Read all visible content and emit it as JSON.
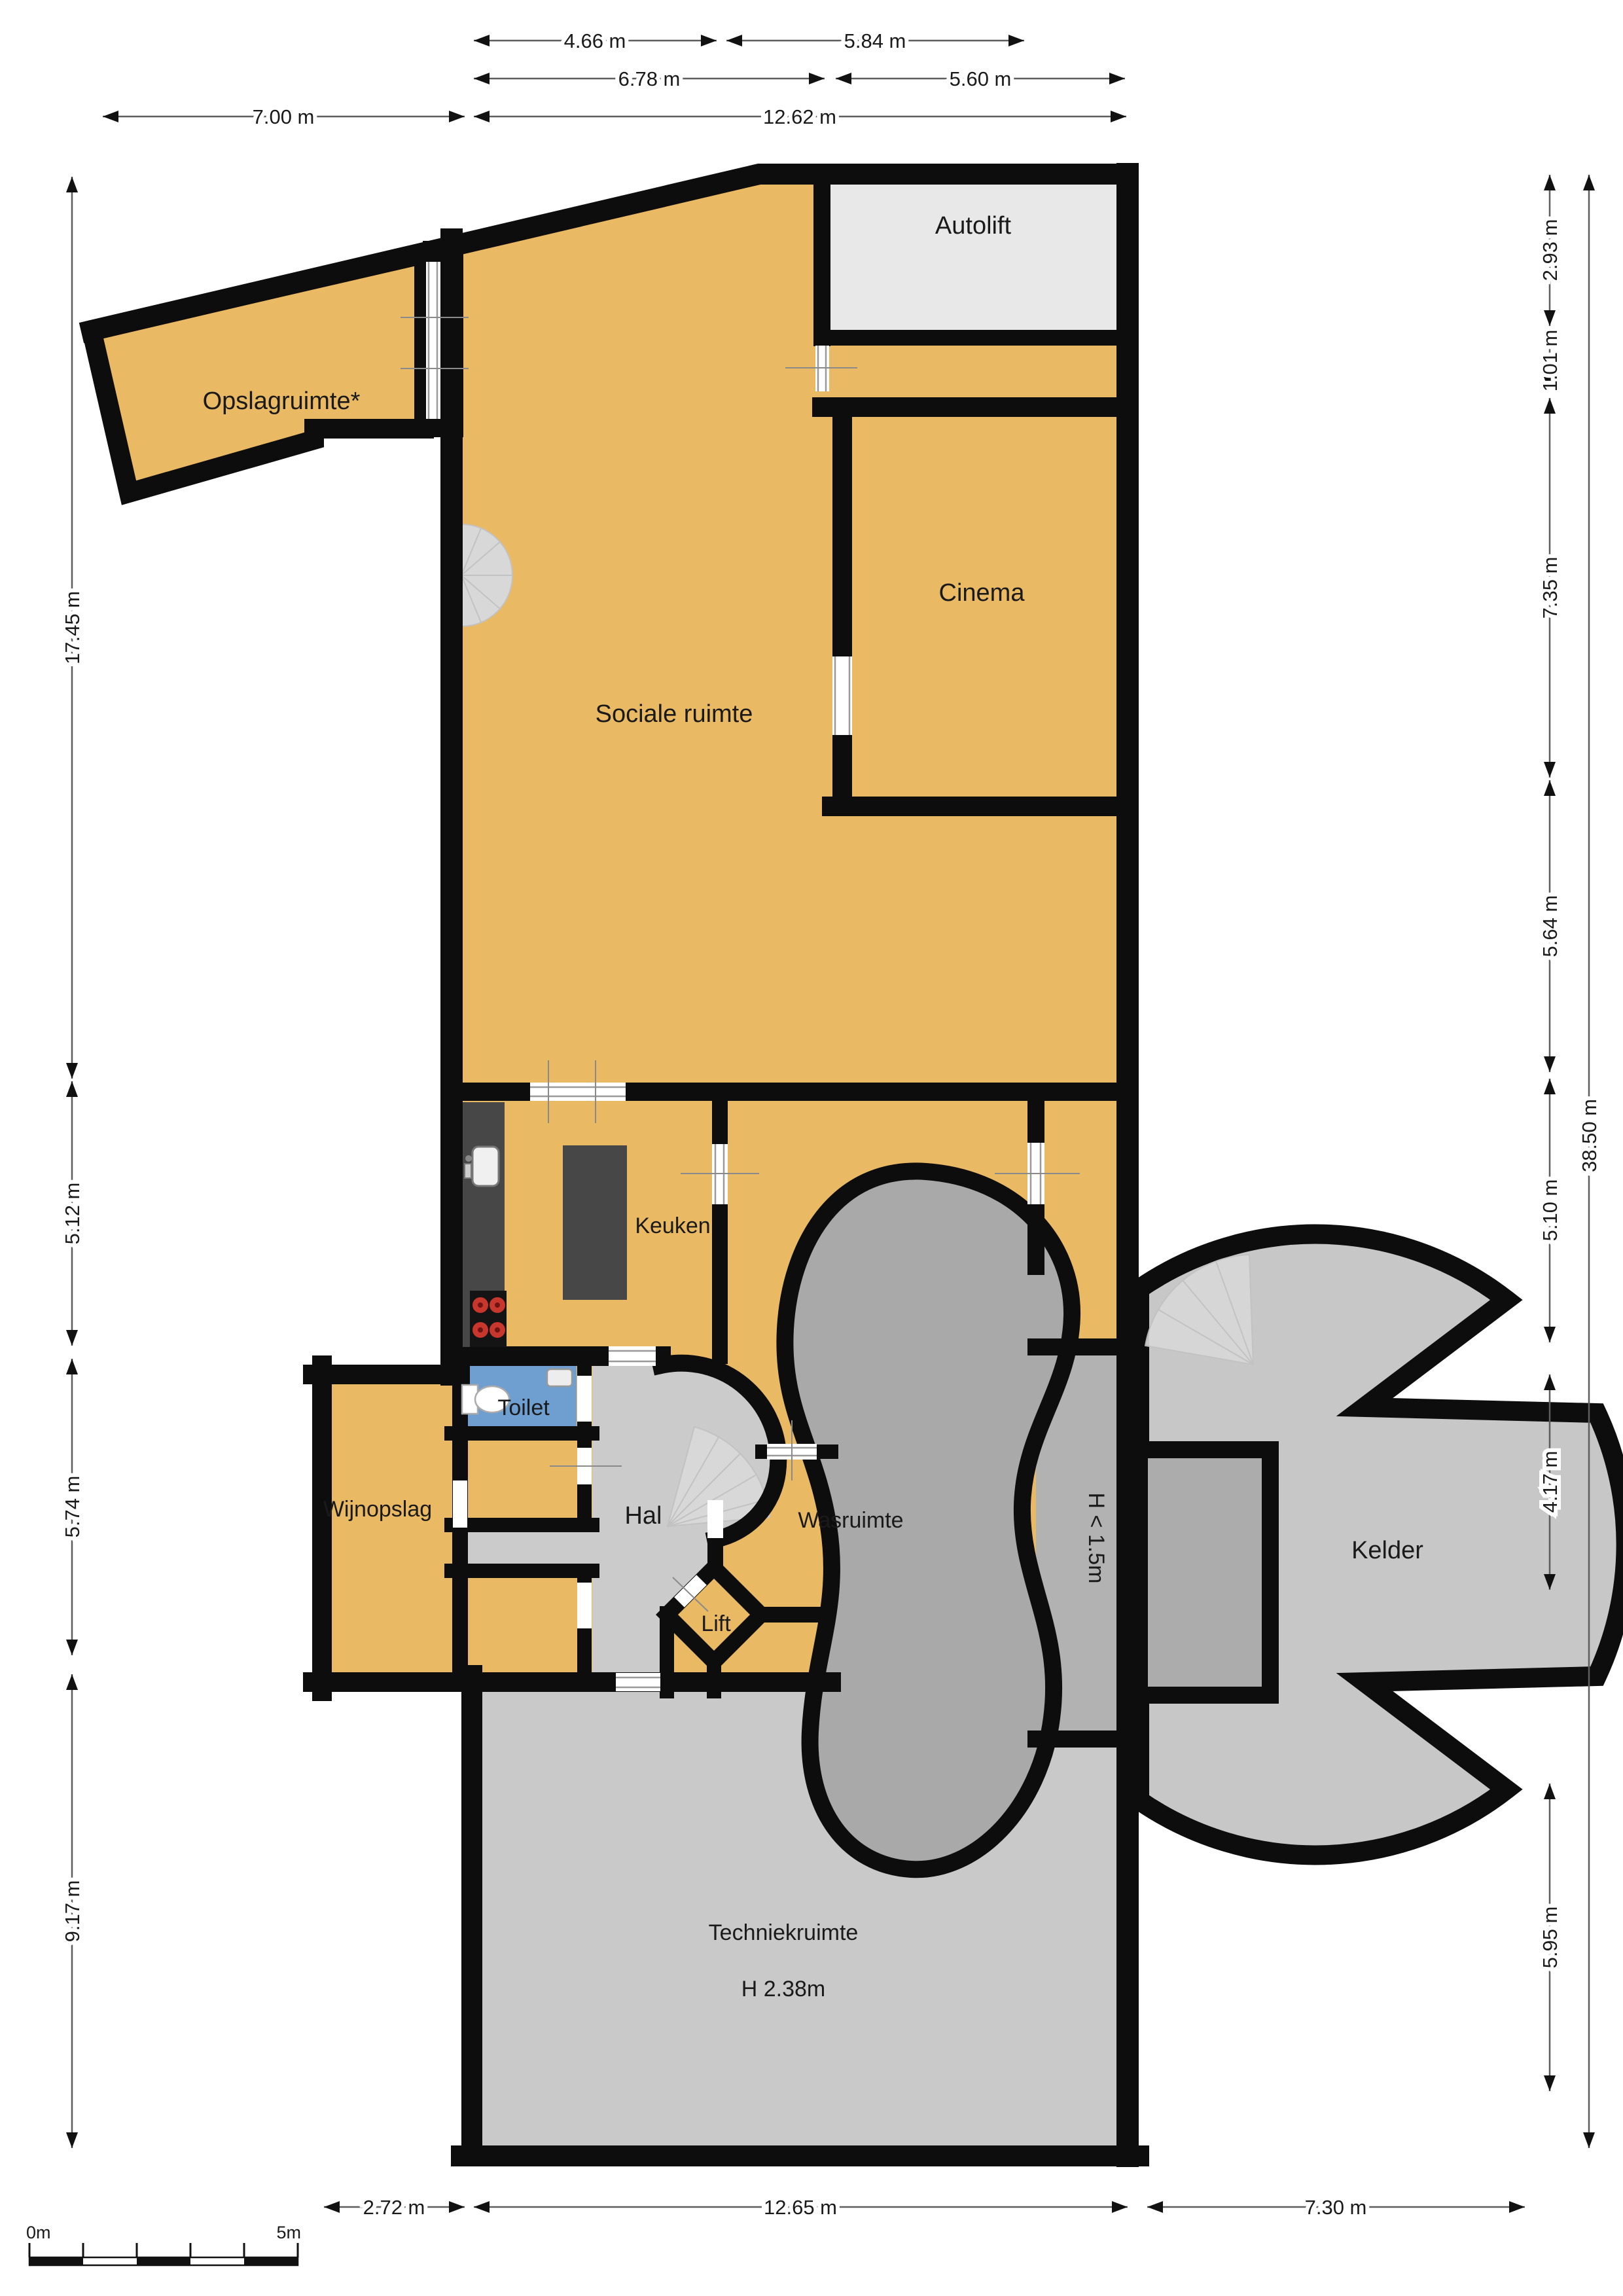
{
  "rooms": {
    "opslagruimte": {
      "label": "Opslagruimte*"
    },
    "autolift": {
      "label": "Autolift"
    },
    "cinema": {
      "label": "Cinema"
    },
    "sociale_ruimte": {
      "label": "Sociale ruimte"
    },
    "keuken": {
      "label": "Keuken"
    },
    "toilet": {
      "label": "Toilet"
    },
    "hal": {
      "label": "Hal"
    },
    "wasruimte": {
      "label": "Wasruimte"
    },
    "lift": {
      "label": "Lift"
    },
    "wijnopslag": {
      "label": "Wijnopslag"
    },
    "kelder": {
      "label": "Kelder"
    },
    "techniekruimte": {
      "label": "Techniekruimte",
      "height_label": "H 2.38m"
    },
    "low_height_zone": {
      "label": "H < 1.5m"
    }
  },
  "dimensions": {
    "top_row1": [
      "4.66 m",
      "5.84 m"
    ],
    "top_row2": [
      "6.78 m",
      "5.60 m"
    ],
    "top_row3": [
      "7.00 m",
      "12.62 m"
    ],
    "left": [
      "17.45 m",
      "5.12 m",
      "5.74 m",
      "9.17 m"
    ],
    "right": [
      "2.93 m",
      "1.01 m",
      "7.35 m",
      "5.64 m",
      "5.10 m",
      "4.17 m",
      "5.95 m"
    ],
    "right_total": "38.50 m",
    "bottom": [
      "2.72 m",
      "12.65 m",
      "7.30 m"
    ]
  },
  "scale_bar": {
    "start": "0m",
    "end": "5m"
  },
  "colors": {
    "room_fill": "#EAB964",
    "wall": "#0D0D0D",
    "hall_floor": "#CBCBCB",
    "autolift_floor": "#E8E8E8",
    "kelder_floor": "#C7C7C7",
    "techniek_floor": "#C9C9C9",
    "rock_fill": "#A9A9A9",
    "low_strip_fill": "#B2B2B2",
    "toilet_floor": "#6F9FD0",
    "counter": "#474747",
    "stair_fill": "#D8D8D8",
    "dim_line": "#5E5E5E",
    "text": "#1A1A1A"
  }
}
